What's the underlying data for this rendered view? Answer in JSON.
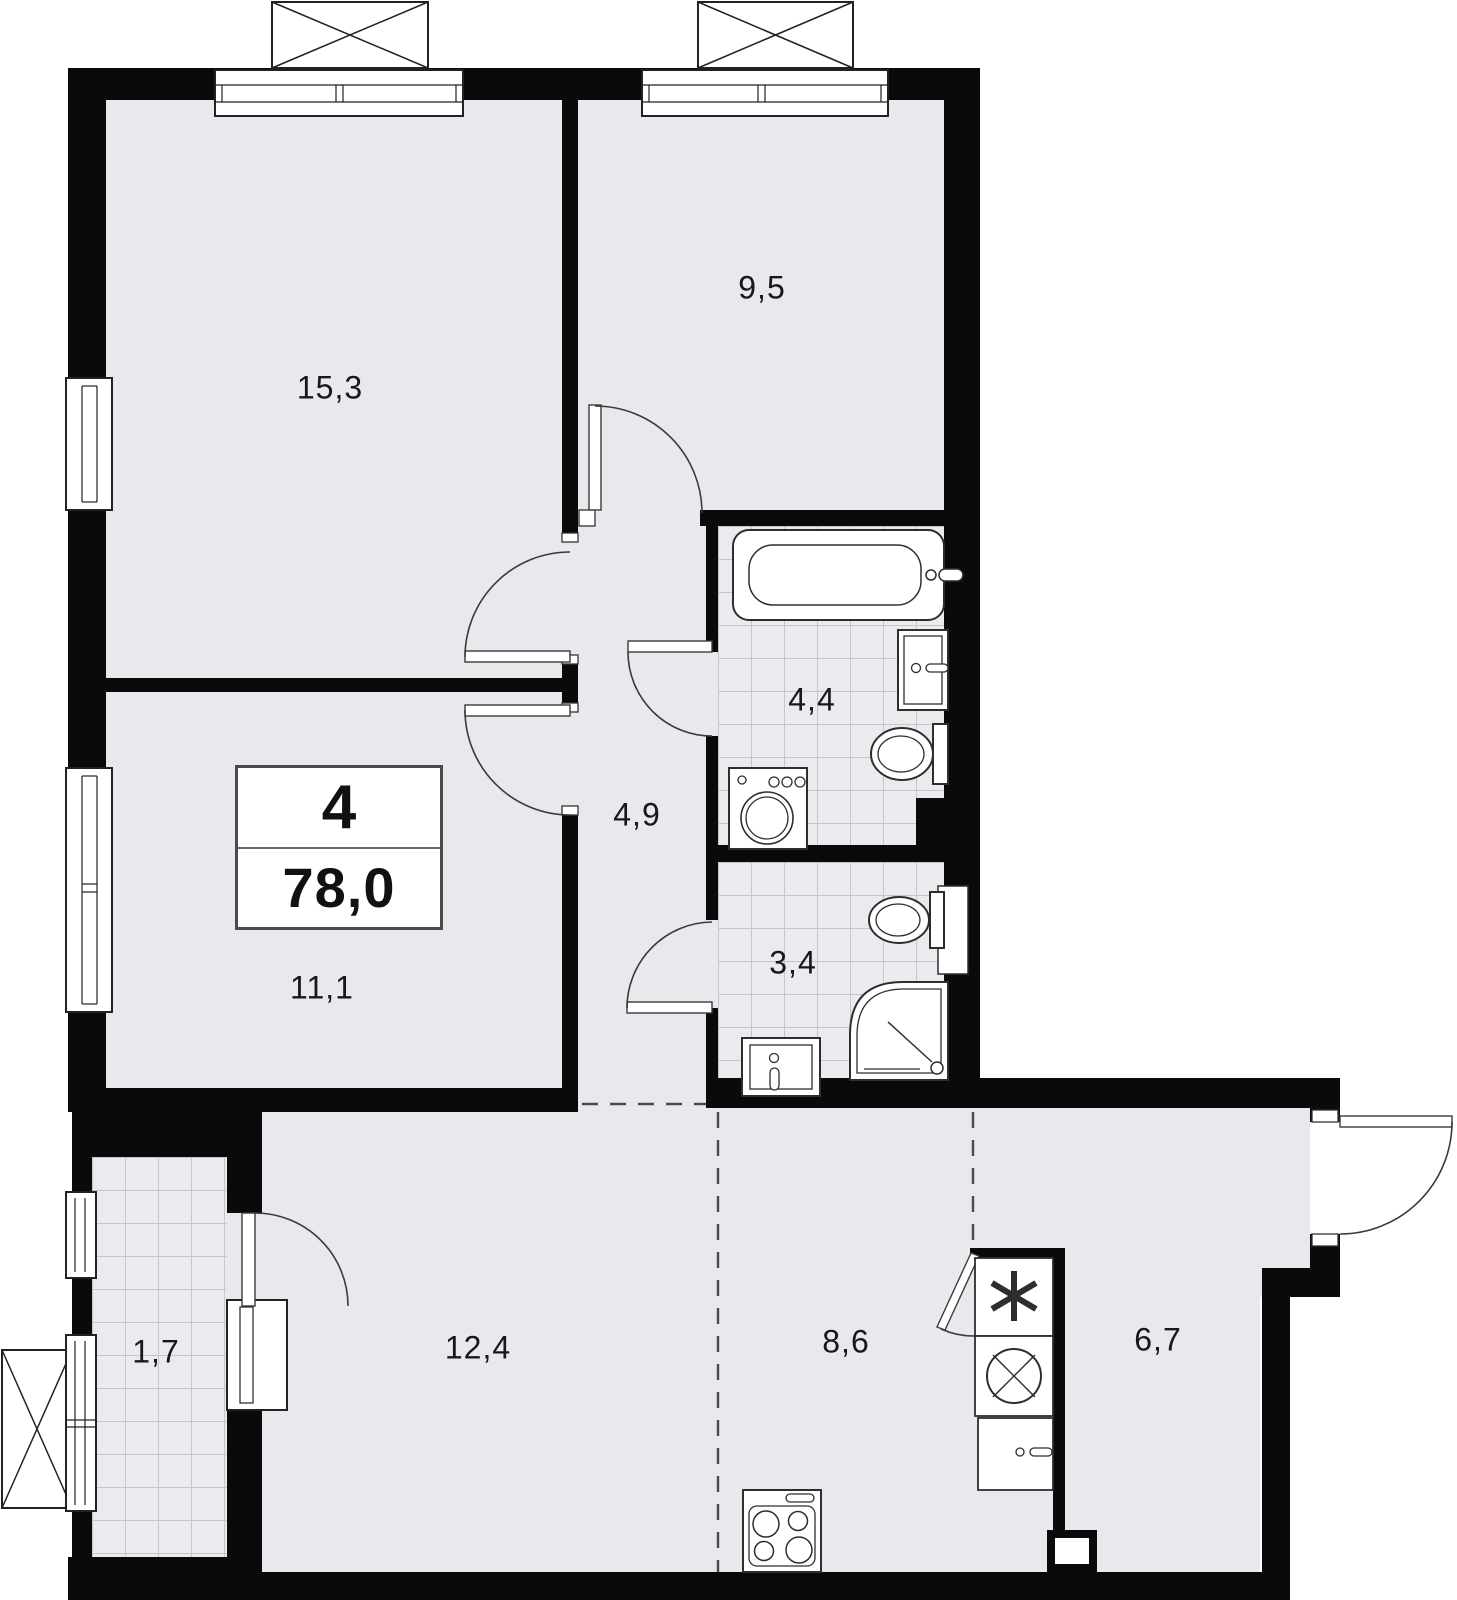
{
  "floor_plan": {
    "info_box": {
      "rooms_count": "4",
      "total_area": "78,0"
    },
    "rooms": [
      {
        "type": "living-room",
        "area": "15,3"
      },
      {
        "type": "bedroom",
        "area": "9,5"
      },
      {
        "type": "bathroom",
        "area": "4,4"
      },
      {
        "type": "hallway",
        "area": "4,9"
      },
      {
        "type": "shower-room",
        "area": "3,4"
      },
      {
        "type": "bedroom-2",
        "area": "11,1"
      },
      {
        "type": "balcony",
        "area": "1,7"
      },
      {
        "type": "living-area",
        "area": "12,4"
      },
      {
        "type": "kitchen",
        "area": "8,6"
      },
      {
        "type": "dining-area",
        "area": "6,7"
      }
    ],
    "fixtures": [
      "bathtub",
      "washbasin",
      "toilet",
      "washing-machine",
      "shower-cabin",
      "kitchen-sink",
      "refrigerator",
      "stove",
      "kitchen-cabinet"
    ],
    "colors": {
      "floor": "#e7e9ec",
      "tile_grid": "#c3c7cc",
      "wall": "#0a0a0a",
      "fixture_outline": "#2e2e2e",
      "background": "#ffffff"
    }
  }
}
